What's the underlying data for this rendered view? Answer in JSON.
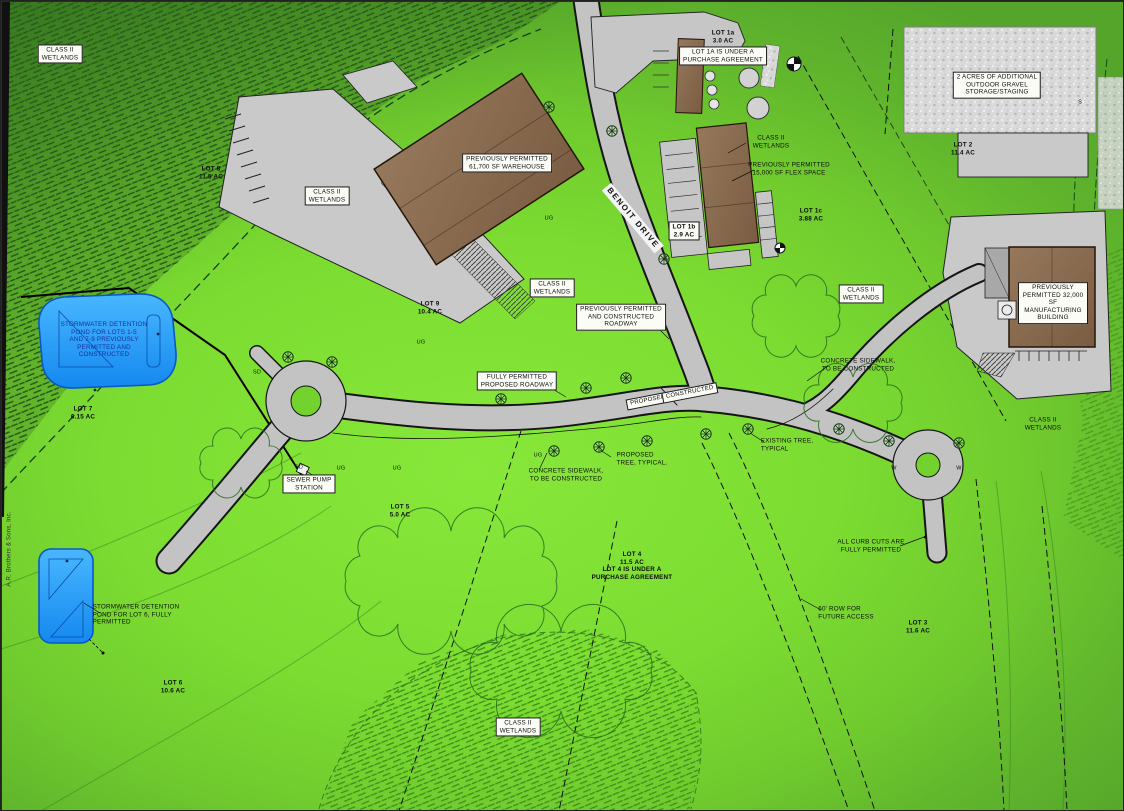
{
  "document": {
    "type": "civil site plan rendering",
    "road_name": "BENOIT DRIVE"
  },
  "colors": {
    "ground": "#7cdc31",
    "road": "#c3c3c3",
    "building": "#8a6b50",
    "pond": "#2ea1f7",
    "wetland_hatch_dark": "#2a5c1d",
    "wetland_hatch_light": "#3f921c",
    "label_box": "#fcfcf7"
  },
  "labels": [
    {
      "id": "wetlands-topleft",
      "text": "CLASS II\nWETLANDS",
      "x": 59,
      "y": 53,
      "boxed": true
    },
    {
      "id": "lot-8-label",
      "text": "LOT 8\n11.5 AC",
      "x": 210,
      "y": 172,
      "lot": true
    },
    {
      "id": "wetlands-left",
      "text": "CLASS II\nWETLANDS",
      "x": 326,
      "y": 195,
      "boxed": true
    },
    {
      "id": "warehouse-label",
      "text": "PREVIOUSLY PERMITTED\n61,700 SF WAREHOUSE",
      "x": 506,
      "y": 162,
      "boxed": true
    },
    {
      "id": "lot-1a-label",
      "text": "LOT 1a\n3.0 AC",
      "x": 722,
      "y": 36,
      "lot": true
    },
    {
      "id": "lot-1a-agreement",
      "text": "LOT 1A IS UNDER A\nPURCHASE AGREEMENT",
      "x": 722,
      "y": 55,
      "boxed": true
    },
    {
      "id": "gravel-label",
      "text": "2 ACRES OF ADDITIONAL\nOUTDOOR GRAVEL\nSTORAGE/STAGING",
      "x": 996,
      "y": 84,
      "boxed": true
    },
    {
      "id": "lot-2-label",
      "text": "LOT 2\n11.4 AC",
      "x": 962,
      "y": 148,
      "lot": true
    },
    {
      "id": "wetlands-flex",
      "text": "CLASS II\nWETLANDS",
      "x": 770,
      "y": 141
    },
    {
      "id": "flex-space-label",
      "text": "PREVIOUSLY PERMITTED\n15,000 SF FLEX SPACE",
      "x": 788,
      "y": 168
    },
    {
      "id": "lot-1c-label",
      "text": "LOT 1c\n3.88 AC",
      "x": 810,
      "y": 214,
      "lot": true
    },
    {
      "id": "benoit-drive-label",
      "text": "BENOIT DRIVE",
      "x": 632,
      "y": 217,
      "rot": 50,
      "road": true
    },
    {
      "id": "lot-1b-label",
      "text": "LOT 1b\n2.9 AC",
      "x": 683,
      "y": 230,
      "lot": true,
      "boxed": true
    },
    {
      "id": "lot-9-label",
      "text": "LOT 9\n10.4 AC",
      "x": 429,
      "y": 307,
      "lot": true
    },
    {
      "id": "wetlands-mid",
      "text": "CLASS II\nWETLANDS",
      "x": 551,
      "y": 287,
      "boxed": true
    },
    {
      "id": "roadway-label",
      "text": "PREVIOUSLY PERMITTED\nAND CONSTRUCTED\nROADWAY",
      "x": 620,
      "y": 316,
      "boxed": true
    },
    {
      "id": "wetlands-right",
      "text": "CLASS II\nWETLANDS",
      "x": 860,
      "y": 293,
      "boxed": true
    },
    {
      "id": "manufacturing-label",
      "text": "PREVIOUSLY\nPERMITTED 32,000 SF\nMANUFACTURING\nBUILDING",
      "x": 1052,
      "y": 302,
      "boxed": true
    },
    {
      "id": "sidewalk-ne-label",
      "text": "CONCRETE SIDEWALK,\nTO BE CONSTRUCTED",
      "x": 857,
      "y": 364
    },
    {
      "id": "pond-1-label",
      "text": "STORMWATER DETENTION\nPOND FOR LOTS 1-5\nAND 7-9 PREVIOUSLY\nPERMITTED AND\nCONSTRUCTED",
      "x": 103,
      "y": 339,
      "color": "#16309f"
    },
    {
      "id": "fully-permitted-label",
      "text": "FULLY PERMITTED\nPROPOSED ROADWAY",
      "x": 516,
      "y": 380,
      "boxed": true
    },
    {
      "id": "proposed-tag",
      "text": "PROPOSED",
      "x": 647,
      "y": 400,
      "boxed": true,
      "rot": -11,
      "fs": 6
    },
    {
      "id": "constructed-tag",
      "text": "CONSTRUCTED",
      "x": 689,
      "y": 392,
      "boxed": true,
      "rot": -11,
      "fs": 6
    },
    {
      "id": "lot-7-label",
      "text": "LOT 7\n6.15 AC",
      "x": 82,
      "y": 412,
      "lot": true
    },
    {
      "id": "wetlands-far-right",
      "text": "CLASS II\nWETLANDS",
      "x": 1042,
      "y": 423
    },
    {
      "id": "existing-tree-label",
      "text": "EXISTING TREE,\nTYPICAL",
      "x": 786,
      "y": 444,
      "align": "left"
    },
    {
      "id": "proposed-tree-label",
      "text": "PROPOSED\nTREE, TYPICAL.",
      "x": 641,
      "y": 458,
      "align": "left"
    },
    {
      "id": "sidewalk-south-label",
      "text": "CONCRETE SIDEWALK,\nTO BE CONSTRUCTED",
      "x": 565,
      "y": 474
    },
    {
      "id": "sewer-pump-label",
      "text": "SEWER PUMP\nSTATION",
      "x": 308,
      "y": 483,
      "boxed": true
    },
    {
      "id": "lot-5-label",
      "text": "LOT 5\n5.0 AC",
      "x": 399,
      "y": 510,
      "lot": true
    },
    {
      "id": "lot-4-label",
      "text": "LOT 4\n11.5 AC\nLOT 4 IS UNDER A\nPURCHASE AGREEMENT",
      "x": 631,
      "y": 565,
      "lot": true
    },
    {
      "id": "curb-cuts-label",
      "text": "ALL CURB CUTS ARE\nFULLY PERMITTED",
      "x": 870,
      "y": 545
    },
    {
      "id": "pond-2-label",
      "text": "STORMWATER DETENTION\nPOND FOR LOT 6, FULLY\nPERMITTED",
      "x": 135,
      "y": 614,
      "align": "left"
    },
    {
      "id": "lot-6-label",
      "text": "LOT 6\n10.6 AC",
      "x": 172,
      "y": 686,
      "lot": true
    },
    {
      "id": "row-label",
      "text": "60' ROW FOR\nFUTURE ACCESS",
      "x": 845,
      "y": 612,
      "align": "left"
    },
    {
      "id": "lot-3-label",
      "text": "LOT 3\n11.6 AC",
      "x": 917,
      "y": 626,
      "lot": true
    },
    {
      "id": "wetlands-bottom",
      "text": "CLASS II\nWETLANDS",
      "x": 517,
      "y": 726,
      "boxed": true
    },
    {
      "id": "side-note",
      "text": "A.R. Brothers & Sons, Inc.",
      "x": 9,
      "y": 548,
      "rot": -90,
      "fs": 6,
      "color": "#333333"
    },
    {
      "id": "util-sd-1",
      "text": "SD",
      "x": 298,
      "y": 467,
      "fs": 5.5
    },
    {
      "id": "util-sd-2",
      "text": "SD",
      "x": 256,
      "y": 372,
      "fs": 5.5
    },
    {
      "id": "util-ug-1",
      "text": "UG",
      "x": 340,
      "y": 468,
      "fs": 5.5
    },
    {
      "id": "util-ug-2",
      "text": "UG",
      "x": 396,
      "y": 468,
      "fs": 5.5
    },
    {
      "id": "util-ug-3",
      "text": "UG",
      "x": 537,
      "y": 455,
      "fs": 5.5
    },
    {
      "id": "util-ug-4",
      "text": "UG",
      "x": 548,
      "y": 218,
      "fs": 5.5
    },
    {
      "id": "util-ug-5",
      "text": "UG",
      "x": 420,
      "y": 342,
      "fs": 5.5
    },
    {
      "id": "util-w-1",
      "text": "W",
      "x": 893,
      "y": 468,
      "fs": 5.5
    },
    {
      "id": "util-w-2",
      "text": "W",
      "x": 958,
      "y": 468,
      "fs": 5.5
    },
    {
      "id": "util-s-1",
      "text": "S",
      "x": 1079,
      "y": 102,
      "fs": 5.5
    }
  ]
}
